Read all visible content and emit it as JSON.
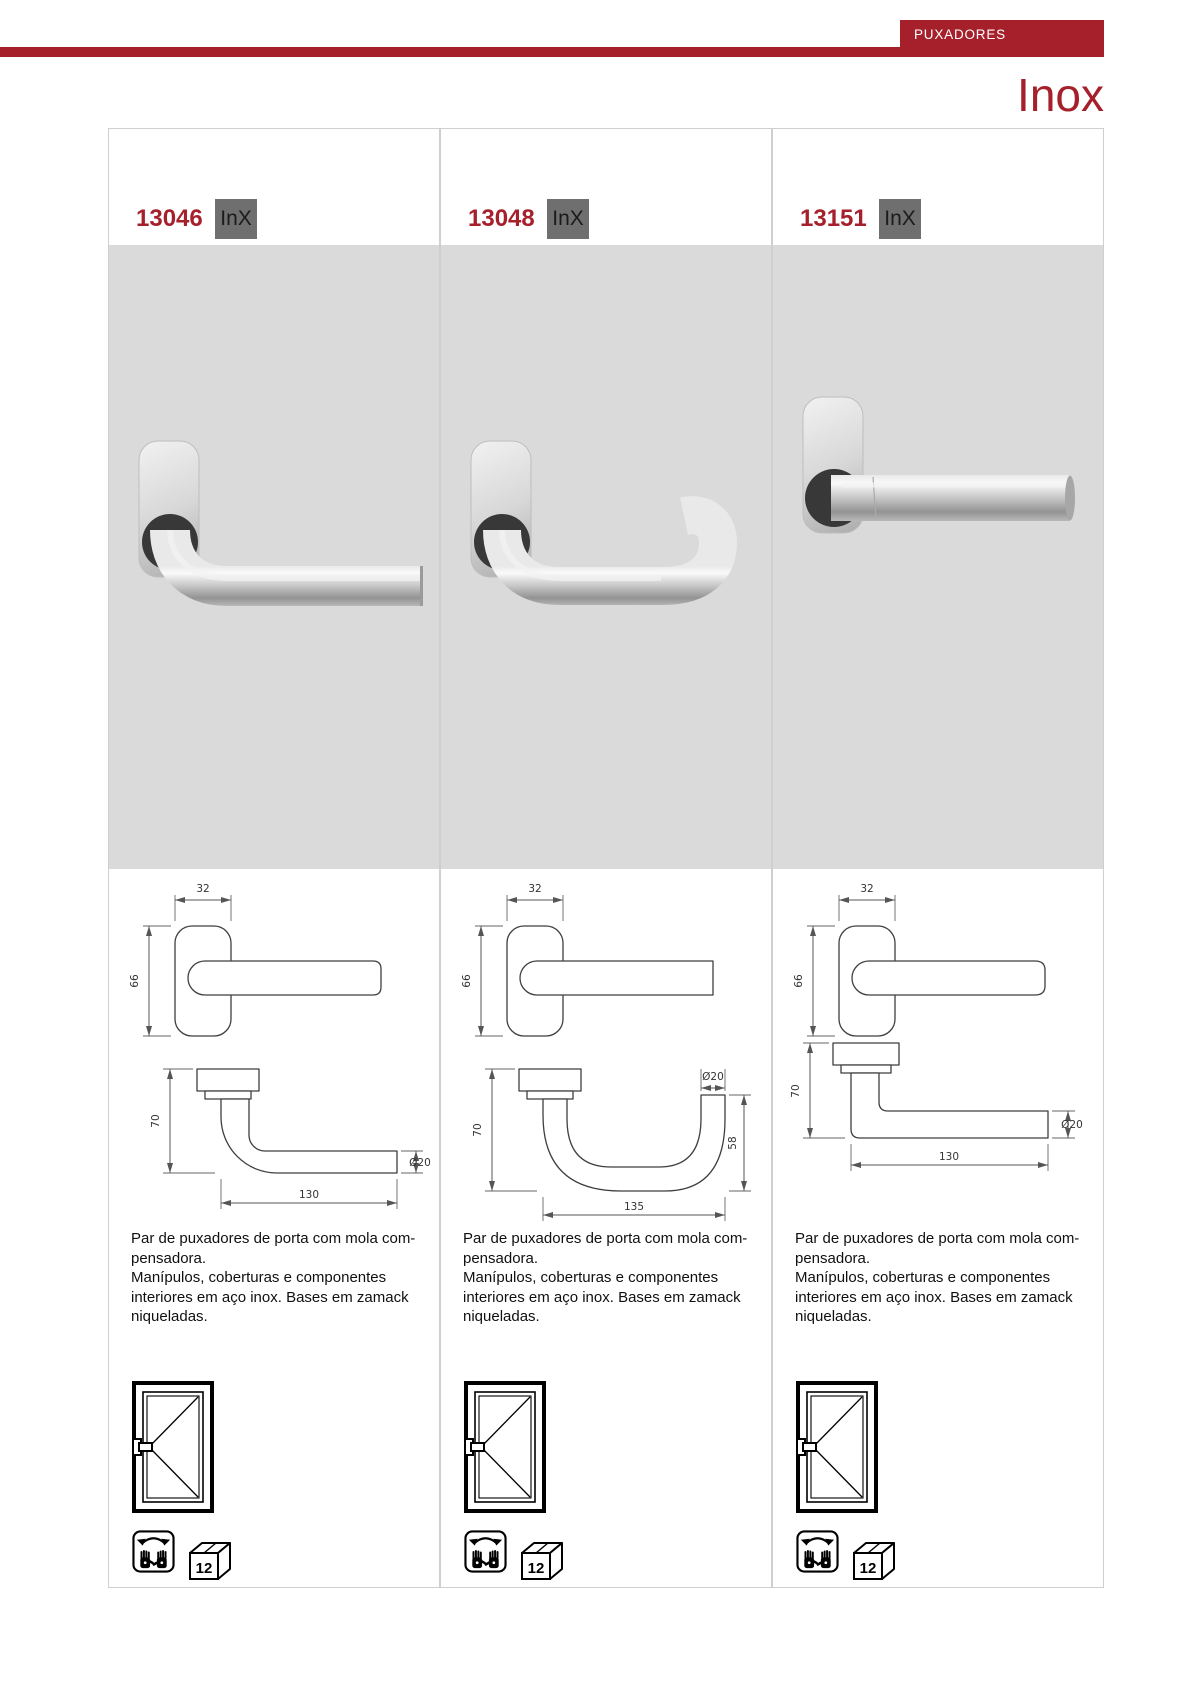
{
  "page": {
    "header_tab": "PUXADORES",
    "title": "Inox",
    "colors": {
      "brand_red": "#A6202C",
      "badge_gray": "#6F6F6F",
      "photo_background": "#DADADA"
    }
  },
  "shared": {
    "description_lines": [
      "Par de puxadores de porta com mola com-",
      "pensadora.",
      "Manípulos, coberturas e componentes",
      "interiores em aço inox. Bases em zamack",
      "niqueladas."
    ],
    "pack_quantity": "12",
    "icons": {
      "door": "door-opening-direction-icon",
      "reversible": "reversible-left-right-hands-icon",
      "pack": "pack-quantity-box-icon"
    }
  },
  "columns": [
    {
      "code": "13046",
      "badge": "InX",
      "drawing": {
        "plate_width": "32",
        "plate_height": "66",
        "handle_height": "70",
        "handle_length": "130",
        "tube_diameter": "Ø20"
      }
    },
    {
      "code": "13048",
      "badge": "InX",
      "drawing": {
        "plate_width": "32",
        "plate_height": "66",
        "handle_height": "70",
        "handle_length": "135",
        "tube_diameter": "Ø20",
        "return_height": "58"
      }
    },
    {
      "code": "13151",
      "badge": "InX",
      "drawing": {
        "plate_width": "32",
        "plate_height": "66",
        "handle_height": "70",
        "handle_length": "130",
        "tube_diameter": "Ø20"
      }
    }
  ]
}
